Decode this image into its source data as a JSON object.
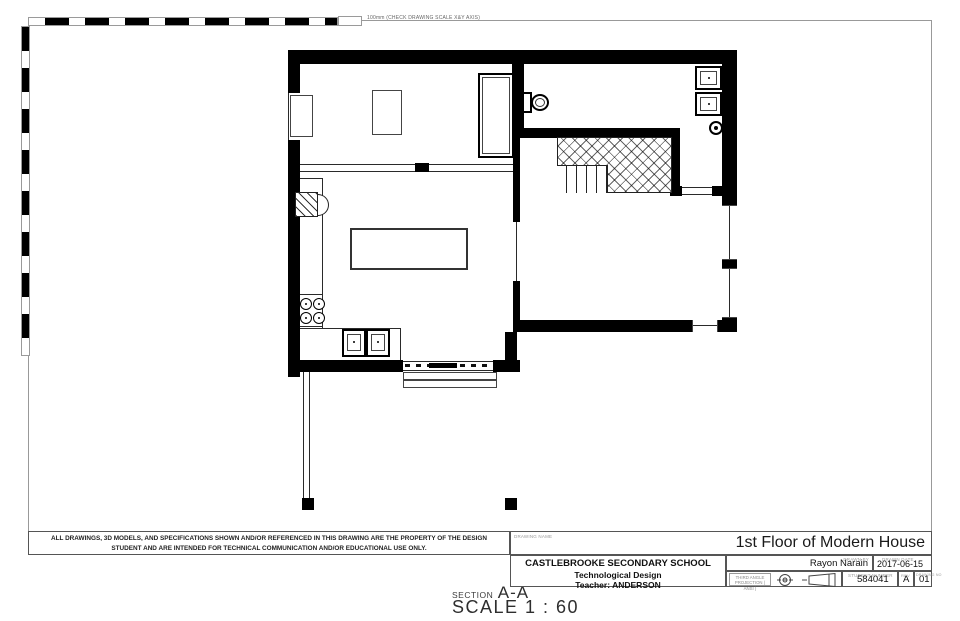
{
  "sheet": {
    "background": "#ffffff",
    "line_color": "#000000",
    "border_color": "#9a9a9a",
    "scale_note": "100mm (CHECK DRAWING SCALE X&Y AXIS)"
  },
  "view_label": {
    "section_prefix": "SECTION",
    "section_name": "A-A",
    "scale_label": "SCALE 1 : 60"
  },
  "disclaimer": "ALL DRAWINGS, 3D MODELS, AND SPECIFICATIONS SHOWN AND/OR REFERENCED IN THIS DRAWING ARE THE PROPERTY OF THE DESIGN STUDENT AND ARE INTENDED FOR TECHNICAL COMMUNICATION AND/OR EDUCATIONAL USE ONLY.",
  "title_block": {
    "drawing_name_label": "DRAWING NAME",
    "drawing_name": "1st Floor of Modern House",
    "school": "CASTLEBROOKE SECONDARY SCHOOL",
    "course": "Technological Design",
    "teacher": "Teacher: ANDERSON",
    "drawn_by_label": "DRAWN BY",
    "drawn_by": "Rayon Narain",
    "drawn_date_label": "DRAWN DATE",
    "drawn_date": "2017-06-15",
    "projection_label": "THIRD ANGLE PROJECTION ( ANSI )",
    "student_number_label": "STUDENT NUMBER",
    "student_number": "584041",
    "rev_label": "REV",
    "rev": "A",
    "drawing_no_label": "DRAWING NO",
    "drawing_no": "01"
  }
}
